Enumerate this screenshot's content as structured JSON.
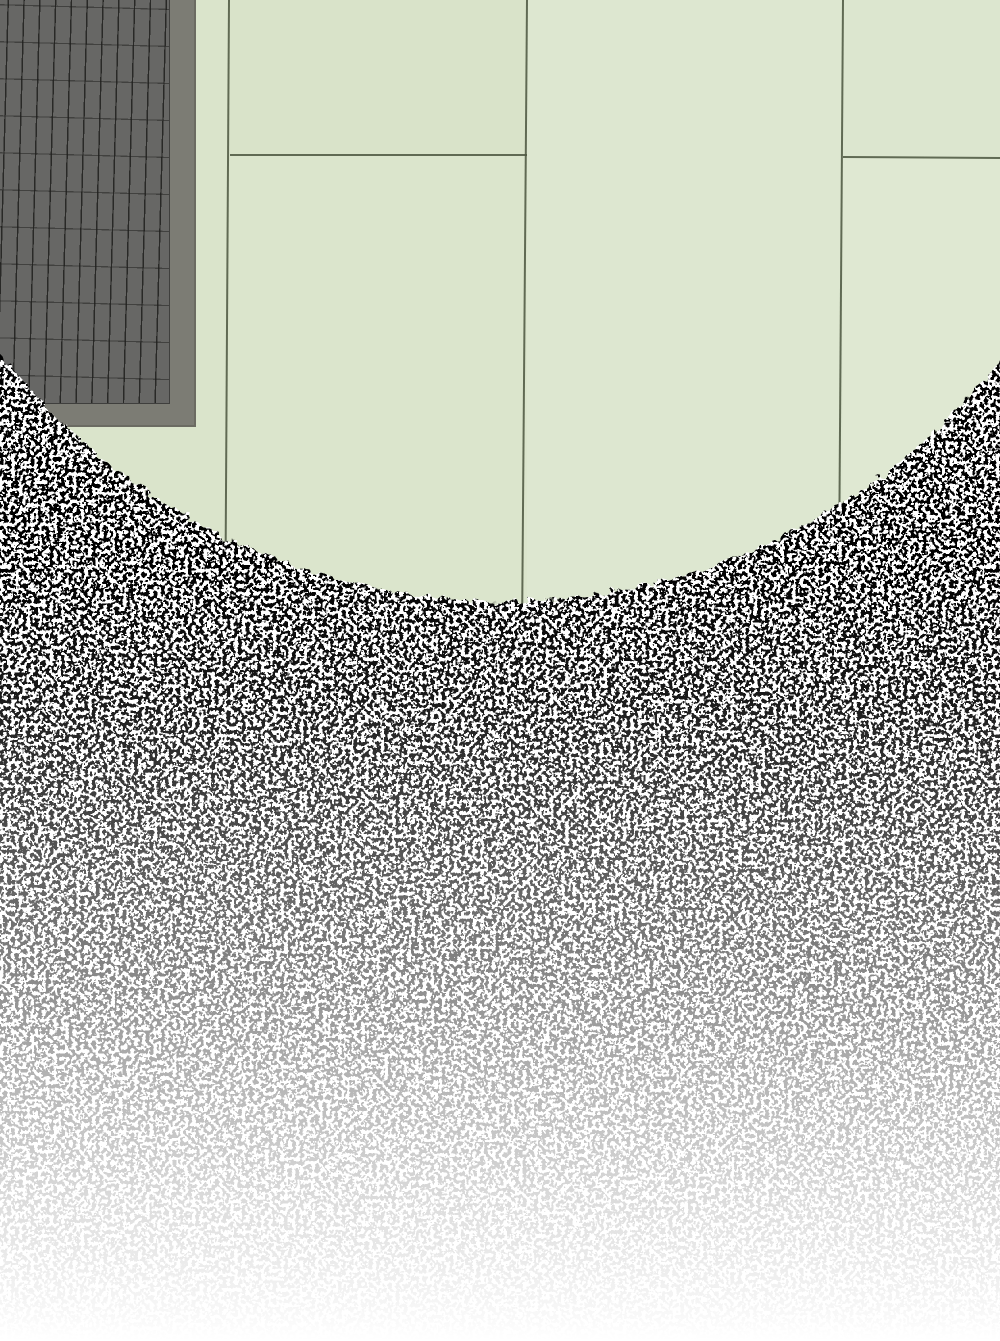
{
  "scene": {
    "description": "Overhead illustration: pale green tiled floor visible through a large circular opening, dark gray gridded mat at top-left, surrounded by dense black speckle texture that fades to white toward the bottom",
    "canvas": {
      "width": 1000,
      "height": 1341
    },
    "floor": {
      "base_tile_color": "#dce6ce",
      "tile_variants": [
        {
          "name": "left-strip",
          "color": "#dae4cb"
        },
        {
          "name": "upper-left-tile",
          "color": "#d9e3c9"
        },
        {
          "name": "lower-left-tile",
          "color": "#dbe5cc"
        },
        {
          "name": "center-tile",
          "color": "#dde7d0"
        },
        {
          "name": "upper-right-tile",
          "color": "#dce6cf"
        },
        {
          "name": "lower-right-tile",
          "color": "#dfe8d2"
        }
      ],
      "grout_color": "#4f5942",
      "grout_lines": [
        {
          "name": "vertical-left",
          "x": 229,
          "y_start": 0,
          "y_end": 540
        },
        {
          "name": "vertical-center",
          "x": 527,
          "y_start": 0,
          "y_end": 600
        },
        {
          "name": "vertical-right",
          "x": 843,
          "y_start": 0,
          "y_end": 500
        },
        {
          "name": "horizontal-left",
          "y": 155,
          "x_start": 230,
          "x_end": 527
        },
        {
          "name": "horizontal-right",
          "y": 157,
          "x_start": 843,
          "x_end": 1000
        }
      ],
      "visible_circle": {
        "cx": "503",
        "cy": "-34",
        "r": "635"
      }
    },
    "mat": {
      "frame_color": "#7c7c74",
      "frame_edge_color": "#6b6b62",
      "tile_color": "#676765",
      "grid_line_color": "rgba(30,30,28,0.85)",
      "grid_line_color_horizontal": "rgba(40,40,38,0.6)",
      "size": {
        "width": 196,
        "height": 427
      },
      "grid_cell": {
        "width": 15.8,
        "height": 37
      }
    },
    "speckle": {
      "description": "black-and-white granular texture, darkest near the circle edge, fading to pure white at the bottom of the image",
      "dark_color": "#000000",
      "light_color": "#ffffff",
      "base_frequency": "0.26",
      "octaves": "2",
      "seed": "7",
      "fill": "#808080",
      "edge_roughness_scale": "13",
      "fade_color": "#ffffff",
      "fade_stops": [
        {
          "offset": "0",
          "opacity": "0"
        },
        {
          "offset": "0.42",
          "opacity": "0"
        },
        {
          "offset": "0.52",
          "opacity": "0.10"
        },
        {
          "offset": "0.61",
          "opacity": "0.28"
        },
        {
          "offset": "0.71",
          "opacity": "0.50"
        },
        {
          "offset": "0.80",
          "opacity": "0.70"
        },
        {
          "offset": "0.90",
          "opacity": "0.87"
        },
        {
          "offset": "0.97",
          "opacity": "0.96"
        },
        {
          "offset": "1",
          "opacity": "1"
        }
      ]
    }
  }
}
